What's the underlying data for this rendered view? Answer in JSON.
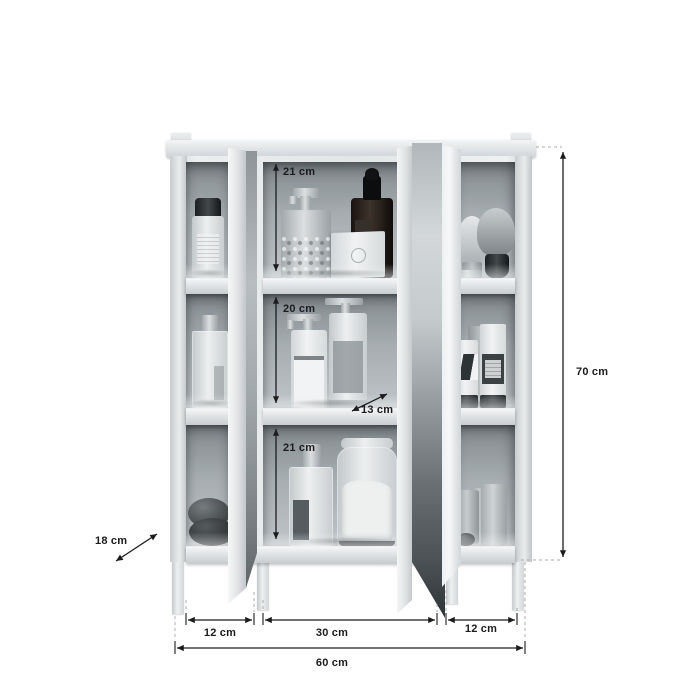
{
  "dimensions": {
    "top_shelf_height": "21 cm",
    "middle_shelf_height": "20 cm",
    "bottom_shelf_height": "21 cm",
    "shelf_depth": "13 cm",
    "side_depth": "18 cm",
    "left_column_width": "12 cm",
    "center_column_width": "30 cm",
    "right_column_width": "12 cm",
    "total_width": "60 cm",
    "total_height": "70 cm"
  },
  "colors": {
    "background": "#ffffff",
    "interior_dark": "#82898d",
    "interior_mid": "#a6adb1",
    "interior_light": "#bcc2c5",
    "mirror_dark": "#4b5154",
    "mirror_light": "#d3d7d9",
    "dim_line": "#1c1c1e",
    "dash_line": "#a9aeb1"
  },
  "products": {
    "left_column": [
      "bottle with black cap",
      "glass perfume bottle",
      "decorative stones"
    ],
    "center_column_top": [
      "pump soap dispenser",
      "cosmetic box",
      "amber dropper bottle"
    ],
    "center_column_middle": [
      "pump lotion bottle",
      "tall pump lotion bottle"
    ],
    "center_column_bottom": [
      "perfume spray bottle",
      "glass jar with bath salts"
    ],
    "right_column": [
      "shaving brushes",
      "cosmetic tubes",
      "pillar candles"
    ]
  }
}
